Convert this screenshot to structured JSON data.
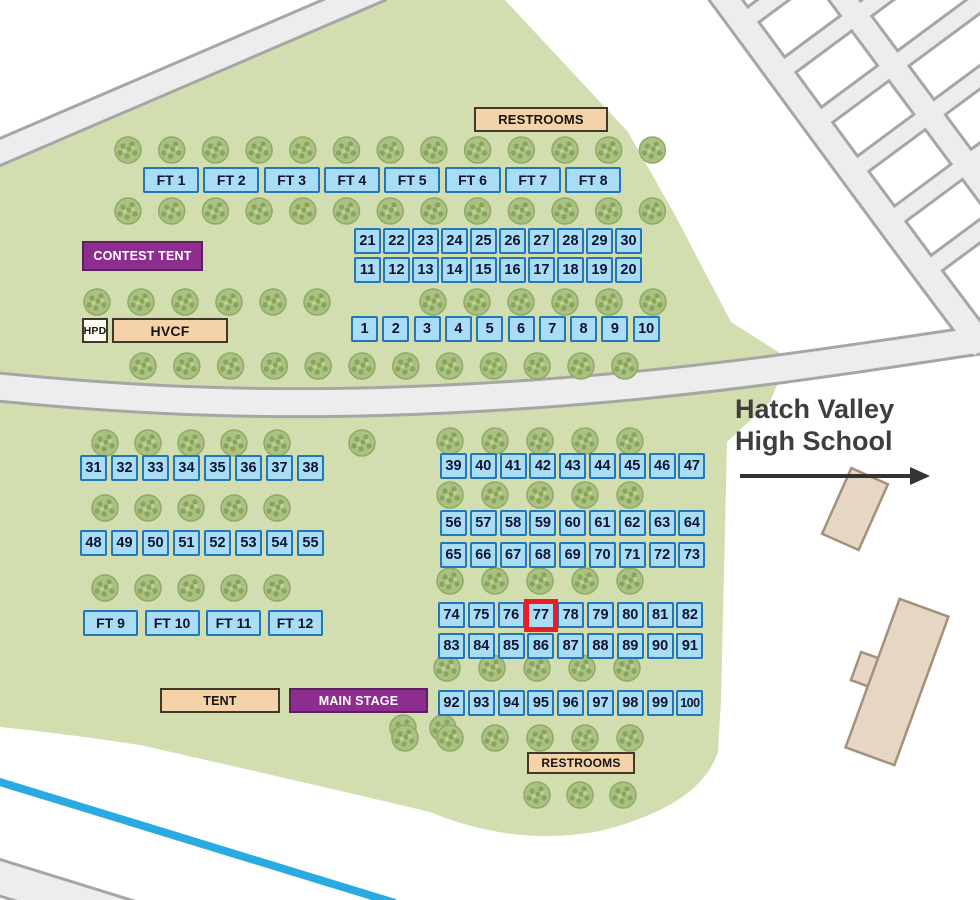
{
  "map_title": {
    "line1": "Hatch Valley",
    "line2": "High School"
  },
  "highlighted_booth": "77",
  "booth_rows": [
    {
      "x": 354,
      "y": 228,
      "pitch": 29.0,
      "numbers": [
        "21",
        "22",
        "23",
        "24",
        "25",
        "26",
        "27",
        "28",
        "29",
        "30"
      ]
    },
    {
      "x": 354,
      "y": 257,
      "pitch": 29.0,
      "numbers": [
        "11",
        "12",
        "13",
        "14",
        "15",
        "16",
        "17",
        "18",
        "19",
        "20"
      ]
    },
    {
      "x": 351,
      "y": 316,
      "pitch": 31.3,
      "numbers": [
        "1",
        "2",
        "3",
        "4",
        "5",
        "6",
        "7",
        "8",
        "9",
        "10"
      ]
    },
    {
      "x": 80,
      "y": 455,
      "pitch": 31.0,
      "numbers": [
        "31",
        "32",
        "33",
        "34",
        "35",
        "36",
        "37",
        "38"
      ]
    },
    {
      "x": 440,
      "y": 453,
      "pitch": 29.8,
      "numbers": [
        "39",
        "40",
        "41",
        "42",
        "43",
        "44",
        "45",
        "46",
        "47"
      ]
    },
    {
      "x": 80,
      "y": 530,
      "pitch": 31.0,
      "numbers": [
        "48",
        "49",
        "50",
        "51",
        "52",
        "53",
        "54",
        "55"
      ]
    },
    {
      "x": 440,
      "y": 510,
      "pitch": 29.8,
      "numbers": [
        "56",
        "57",
        "58",
        "59",
        "60",
        "61",
        "62",
        "63",
        "64"
      ]
    },
    {
      "x": 440,
      "y": 542,
      "pitch": 29.8,
      "numbers": [
        "65",
        "66",
        "67",
        "68",
        "69",
        "70",
        "71",
        "72",
        "73"
      ]
    },
    {
      "x": 438,
      "y": 602,
      "pitch": 29.8,
      "numbers": [
        "74",
        "75",
        "76",
        "77",
        "78",
        "79",
        "80",
        "81",
        "82"
      ]
    },
    {
      "x": 438,
      "y": 633,
      "pitch": 29.8,
      "numbers": [
        "83",
        "84",
        "85",
        "86",
        "87",
        "88",
        "89",
        "90",
        "91"
      ]
    },
    {
      "x": 438,
      "y": 690,
      "pitch": 29.8,
      "numbers": [
        "92",
        "93",
        "94",
        "95",
        "96",
        "97",
        "98",
        "99",
        "100"
      ]
    }
  ],
  "food_tent_rows": [
    {
      "x": 143,
      "y": 167,
      "pitch": 60.3,
      "w": 56,
      "labels": [
        "FT 1",
        "FT 2",
        "FT 3",
        "FT 4",
        "FT 5",
        "FT 6",
        "FT 7",
        "FT 8"
      ]
    },
    {
      "x": 83,
      "y": 610,
      "pitch": 61.5,
      "w": 55,
      "labels": [
        "FT 9",
        "FT 10",
        "FT 11",
        "FT 12"
      ]
    }
  ],
  "facilities": [
    {
      "id": "restrooms-top",
      "label": "RESTROOMS",
      "style": "tan",
      "x": 474,
      "y": 107,
      "w": 134,
      "h": 25,
      "fs": 13
    },
    {
      "id": "contest-tent",
      "label": "CONTEST TENT",
      "style": "purple",
      "x": 82,
      "y": 241,
      "w": 121,
      "h": 30,
      "fs": 12.5
    },
    {
      "id": "hpd",
      "label": "HPD",
      "style": "white",
      "x": 82,
      "y": 318,
      "w": 26,
      "h": 25,
      "fs": 10.5
    },
    {
      "id": "hvcf",
      "label": "HVCF",
      "style": "tan",
      "x": 112,
      "y": 318,
      "w": 116,
      "h": 25,
      "fs": 14
    },
    {
      "id": "tent",
      "label": "TENT",
      "style": "tan",
      "x": 160,
      "y": 688,
      "w": 120,
      "h": 25,
      "fs": 12.5
    },
    {
      "id": "main-stage",
      "label": "MAIN STAGE",
      "style": "purple",
      "x": 289,
      "y": 688,
      "w": 139,
      "h": 25,
      "fs": 12.5
    },
    {
      "id": "restrooms-bottom",
      "label": "RESTROOMS",
      "style": "tan",
      "x": 527,
      "y": 752,
      "w": 108,
      "h": 22,
      "fs": 12
    }
  ],
  "colors": {
    "park": "#d2ddb0",
    "road_fill": "#ededed",
    "road_edge": "#a6a6a6",
    "canal": "#29abe2",
    "booth_fill": "#a9dcf5",
    "booth_border": "#2276bb",
    "booth_text": "#101433",
    "highlight": "#ed1c24",
    "tan_fill": "#f5d3a8",
    "tan_border": "#42382a",
    "purple_fill": "#8e2d90",
    "purple_border": "#5c2060",
    "white_fill": "#fdfcf2",
    "tree_fill": "#a9c181",
    "tree_edge": "#90aa66",
    "tree_dot": "#8aa45c",
    "building_fill": "#e6d6c4",
    "building_edge": "#a5907b",
    "label_text": "#3e3e3e"
  }
}
